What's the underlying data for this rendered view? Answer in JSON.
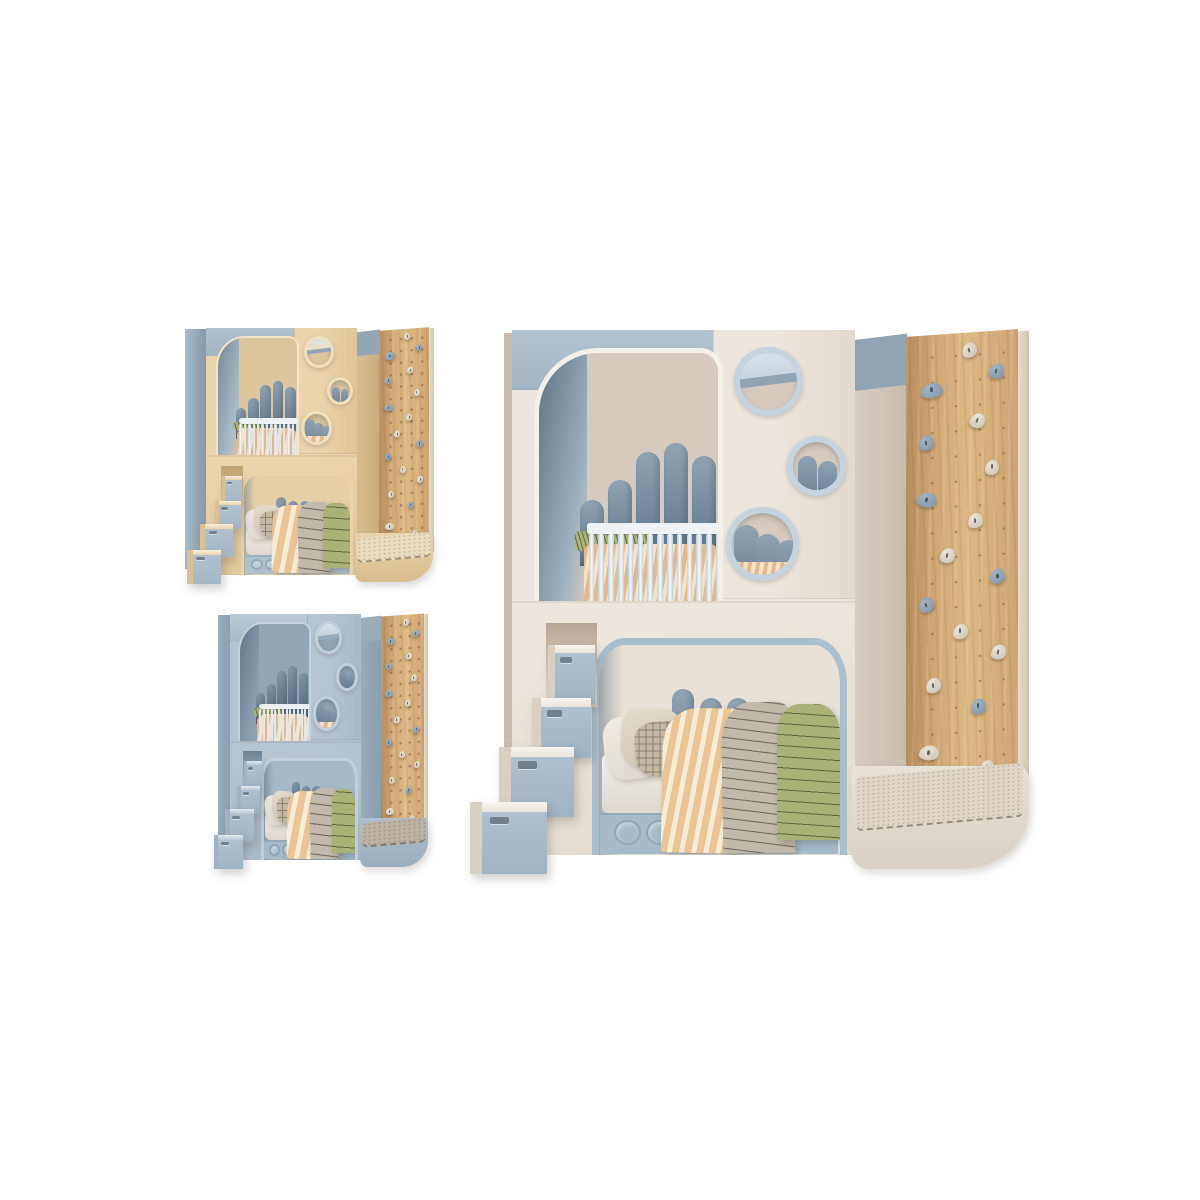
{
  "page": {
    "background": "#FFFFFF"
  },
  "views": [
    {
      "id": "thumbnail-top-left",
      "variant": "beige",
      "size": "small"
    },
    {
      "id": "thumbnail-bottom-left",
      "variant": "blue",
      "size": "small"
    },
    {
      "id": "main-view-right",
      "variant": "cream",
      "size": "large"
    }
  ],
  "palettes": {
    "cream": {
      "body": "#EDE6DE",
      "bodyGrad": "#E2D9CE",
      "side": "#D8CEC3",
      "sideDark": "#C8BCAE",
      "band": "#B4C3D1",
      "bandSide": "#92A4B3",
      "trim": "#F3F0EA",
      "ring": "#C6D3DE",
      "nookBackUpper": "#D6CABE",
      "nookBackLower": "#E9E1D7",
      "nookLeftLight": "#9FB2C1",
      "nookLeftDark": "#5E7385",
      "velvet": "#72879A",
      "velvetLight": "#8FA3B3",
      "velvetDark": "#5D7285",
      "railFrame": "#EEF2F5",
      "railBar": "#BECFDA",
      "lowerTrim": "#ABBECC",
      "drawer": "#A6BAC9",
      "drawerEdge": "#93A8B8",
      "stairBody": "#EAE4DB",
      "stairSide": "#D9D0C4",
      "stairFront": "#AFC0CE",
      "platform": "#E8E1D7",
      "platformSide": "#D9D0C4",
      "mat": "#DFD6C8",
      "niche": "#B7A795"
    },
    "beige": {
      "body": "#EBD3AC",
      "bodyGrad": "#E1C596",
      "side": "#D9BD90",
      "sideDark": "#C9AC7E",
      "band": "#B2C1CE",
      "bandSide": "#94A6B5",
      "trim": "#F2E4C4",
      "ring": "#EFE0BE",
      "nookBackUpper": "#DDC69E",
      "nookBackLower": "#E6CFA7",
      "nookLeftLight": "#A9BAC8",
      "nookLeftDark": "#76899B",
      "velvet": "#72879A",
      "velvetLight": "#8FA3B3",
      "velvetDark": "#5D7285",
      "railFrame": "#EEF2F5",
      "railBar": "#C6D4DF",
      "lowerTrim": "#E9D4AE",
      "drawer": "#AFC0CD",
      "drawerEdge": "#9CB0BF",
      "stairBody": "#EAD2AB",
      "stairSide": "#DCBF93",
      "stairFront": "#B0C0CE",
      "platform": "#E9D2AB",
      "platformSide": "#D9BC8E",
      "mat": "#EADCBC",
      "niche": "#C0A172"
    },
    "blue": {
      "body": "#B6C4D1",
      "bodyGrad": "#A9B9C8",
      "side": "#9BACBC",
      "sideDark": "#8B9DAE",
      "band": "#BCC9D5",
      "bandSide": "#9AABBA",
      "trim": "#C5D2DC",
      "ring": "#C2CFDA",
      "nookBackUpper": "#93A5B4",
      "nookBackLower": "#A7B8C6",
      "nookLeftLight": "#8A9DAE",
      "nookLeftDark": "#64788A",
      "velvet": "#677C8F",
      "velvetLight": "#839AAB",
      "velvetDark": "#53677A",
      "railFrame": "#ECF0F3",
      "railBar": "#CBD8E1",
      "lowerTrim": "#C3D0DB",
      "drawer": "#A5B9C8",
      "drawerEdge": "#92A7B7",
      "stairBody": "#B9C7D3",
      "stairSide": "#A2B2C1",
      "stairFront": "#AFC0CE",
      "platform": "#AEBECC",
      "platformSide": "#9CADBC",
      "mat": "#BCB2A4",
      "niche": "#6E8294"
    }
  },
  "shared": {
    "colors": {
      "sheet": "#F5F2ED",
      "sheetShadow": "#DDD7CE",
      "pillowWhite": "#F0ECE4",
      "pillowCream": "#E3DBCB",
      "pillowPlaidBase": "#C3B8A6",
      "pillowPlaidLine": "#8E8270",
      "blanketOrange": "#EAC493",
      "blanketOrangeStripe": "#F7ECD8",
      "blanketGray": "#C0B9AC",
      "blanketGrayLine": "#6B6558",
      "blanketGreen": "#ABB277",
      "blanketGreenLine": "#606A45",
      "wood": "#CFA472",
      "woodDark": "#B78C5D",
      "woodLight": "#DEB984",
      "woodEdge": "#E6DDCE",
      "pegHole": "#7A5534",
      "holdLight": "#E9E3D8",
      "holdLightShade": "#C9C0B1",
      "holdBlue": "#A2B4C3",
      "holdBlueShade": "#7F94A6",
      "holdDot": "#333E48",
      "cribStripe1": "#E3B98B",
      "cribStripe2": "#F4E3C8",
      "portGlassTop": "#D8E1E7"
    },
    "upper_velvet_heights": [
      36,
      47,
      62,
      67,
      60
    ],
    "lower_velvet_heights": [
      52,
      74,
      88,
      82,
      82,
      62,
      68,
      72
    ],
    "crib_bar_count": 14,
    "climb_holds": [
      {
        "x": 50,
        "y": 2,
        "c": "L",
        "r": -15
      },
      {
        "x": 74,
        "y": 7,
        "c": "B",
        "r": 10
      },
      {
        "x": 13,
        "y": 10,
        "c": "B",
        "r": 0,
        "w": 20
      },
      {
        "x": 57,
        "y": 17,
        "c": "L",
        "r": 20
      },
      {
        "x": 12,
        "y": 21,
        "c": "B",
        "r": -10
      },
      {
        "x": 70,
        "y": 27,
        "c": "L",
        "r": 0
      },
      {
        "x": 10,
        "y": 33,
        "c": "B",
        "r": 15,
        "w": 18
      },
      {
        "x": 55,
        "y": 38,
        "c": "L",
        "r": -5
      },
      {
        "x": 30,
        "y": 45,
        "c": "L",
        "r": 10
      },
      {
        "x": 75,
        "y": 50,
        "c": "B",
        "r": 0
      },
      {
        "x": 12,
        "y": 55,
        "c": "B",
        "r": -20
      },
      {
        "x": 42,
        "y": 61,
        "c": "L",
        "r": 0
      },
      {
        "x": 76,
        "y": 66,
        "c": "L",
        "r": 12
      },
      {
        "x": 18,
        "y": 72,
        "c": "L",
        "r": -8
      },
      {
        "x": 58,
        "y": 77,
        "c": "B",
        "r": 0
      },
      {
        "x": 12,
        "y": 86,
        "c": "L",
        "r": 10,
        "w": 18
      },
      {
        "x": 66,
        "y": 90,
        "c": "L",
        "r": -12
      }
    ]
  }
}
